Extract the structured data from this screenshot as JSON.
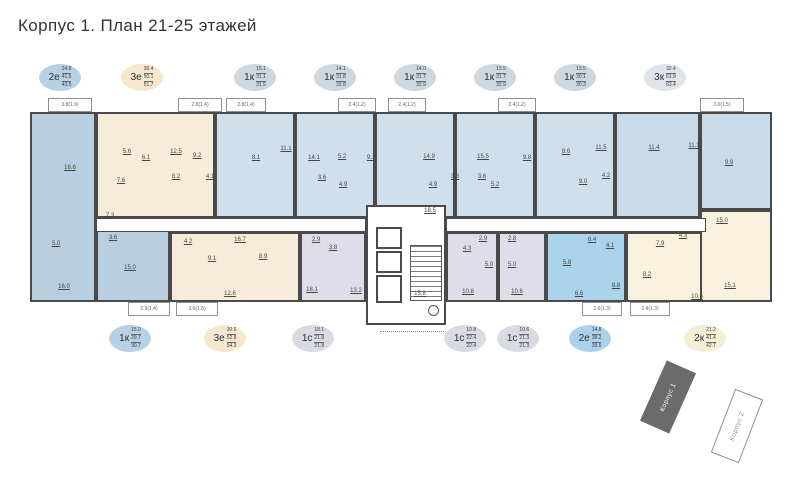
{
  "title": "Корпус 1. План 21-25 этажей",
  "colors": {
    "wall": "#4a4a4a",
    "background": "#ffffff",
    "blue": "#b9cfe0",
    "light_blue": "#cfdfeb",
    "pale_blue": "#c9dbe9",
    "bright_blue": "#abd3ec",
    "beige": "#f6ecd9",
    "cream": "#f7f1dd",
    "lavender": "#dedde8"
  },
  "badges_top": [
    {
      "type": "2е",
      "values": [
        "24.8",
        "41.6",
        "43.5"
      ],
      "fill": "#b8d0e4",
      "x": 60
    },
    {
      "type": "3е",
      "values": [
        "30.4",
        "50.1",
        "51.7"
      ],
      "fill": "#f5e8cf",
      "x": 142
    },
    {
      "type": "1к",
      "values": [
        "15.1",
        "31.1",
        "31.5"
      ],
      "fill": "#ccd8e2",
      "x": 255
    },
    {
      "type": "1к",
      "values": [
        "14.1",
        "31.8",
        "32.8"
      ],
      "fill": "#ccd8e2",
      "x": 335
    },
    {
      "type": "1к",
      "values": [
        "14.0",
        "31.7",
        "32.9"
      ],
      "fill": "#ccd8e2",
      "x": 415
    },
    {
      "type": "1к",
      "values": [
        "13.9",
        "31.7",
        "32.9"
      ],
      "fill": "#ccd8e2",
      "x": 495
    },
    {
      "type": "1к",
      "values": [
        "13.5",
        "30.1",
        "30.3"
      ],
      "fill": "#ccd8e2",
      "x": 575
    },
    {
      "type": "3к",
      "values": [
        "32.4",
        "61.9",
        "63.4"
      ],
      "fill": "#dfe4ea",
      "x": 665
    }
  ],
  "badges_bottom": [
    {
      "type": "1к",
      "values": [
        "15.0",
        "29.7",
        "30.7"
      ],
      "fill": "#b8d0e4",
      "x": 130
    },
    {
      "type": "3е",
      "values": [
        "30.6",
        "52.8",
        "54.3"
      ],
      "fill": "#f5e8cf",
      "x": 225
    },
    {
      "type": "1с",
      "values": [
        "18.1",
        "21.8",
        "21.8"
      ],
      "fill": "#d8dae4",
      "x": 313
    },
    {
      "type": "1с",
      "values": [
        "10.8",
        "22.4",
        "22.4"
      ],
      "fill": "#d8dae4",
      "x": 465
    },
    {
      "type": "1с",
      "values": [
        "10.6",
        "21.3",
        "21.3"
      ],
      "fill": "#d8dae4",
      "x": 518
    },
    {
      "type": "2е",
      "values": [
        "14.8",
        "38.2",
        "39.6"
      ],
      "fill": "#aad2ec",
      "x": 590
    },
    {
      "type": "2к",
      "values": [
        "21.2",
        "41.4",
        "42.7"
      ],
      "fill": "#f5eed6",
      "x": 705
    }
  ],
  "plan": {
    "apartments": [
      {
        "id": "2e-left",
        "fill": "#b9cfe0",
        "x": 30,
        "y": 112,
        "w": 66,
        "h": 190
      },
      {
        "id": "3e-top",
        "fill": "#f6ecd9",
        "x": 96,
        "y": 112,
        "w": 119,
        "h": 106
      },
      {
        "id": "1k-top-1",
        "fill": "#cfdfeb",
        "x": 215,
        "y": 112,
        "w": 80,
        "h": 106
      },
      {
        "id": "1k-top-2",
        "fill": "#cfdfeb",
        "x": 295,
        "y": 112,
        "w": 80,
        "h": 106
      },
      {
        "id": "1k-top-3",
        "fill": "#cfdfeb",
        "x": 375,
        "y": 112,
        "w": 80,
        "h": 106
      },
      {
        "id": "1k-top-4",
        "fill": "#cfdfeb",
        "x": 455,
        "y": 112,
        "w": 80,
        "h": 106
      },
      {
        "id": "1k-top-5",
        "fill": "#cfdfeb",
        "x": 535,
        "y": 112,
        "w": 80,
        "h": 106
      },
      {
        "id": "3k",
        "fill": "#c9dbe9",
        "x": 615,
        "y": 112,
        "w": 85,
        "h": 106
      },
      {
        "id": "3k-wing",
        "fill": "#c9dbe9",
        "x": 700,
        "y": 112,
        "w": 72,
        "h": 98
      },
      {
        "id": "1k-bottom",
        "fill": "#b9cfe0",
        "x": 96,
        "y": 230,
        "w": 74,
        "h": 72
      },
      {
        "id": "3e-bottom",
        "fill": "#f6ecd9",
        "x": 170,
        "y": 232,
        "w": 130,
        "h": 70
      },
      {
        "id": "1c-1",
        "fill": "#dedde8",
        "x": 300,
        "y": 232,
        "w": 66,
        "h": 70
      },
      {
        "id": "1c-2",
        "fill": "#dedde8",
        "x": 446,
        "y": 232,
        "w": 52,
        "h": 70
      },
      {
        "id": "1c-3",
        "fill": "#dedde8",
        "x": 498,
        "y": 232,
        "w": 48,
        "h": 70
      },
      {
        "id": "2e-bottom",
        "fill": "#abd3ec",
        "x": 546,
        "y": 232,
        "w": 80,
        "h": 70
      },
      {
        "id": "2k",
        "fill": "#f7f1dd",
        "x": 626,
        "y": 232,
        "w": 146,
        "h": 70
      },
      {
        "id": "2k-wing",
        "fill": "#f7f1dd",
        "x": 700,
        "y": 210,
        "w": 72,
        "h": 92
      }
    ],
    "corridors": [
      {
        "x": 96,
        "y": 218,
        "w": 270,
        "h": 14
      },
      {
        "x": 446,
        "y": 218,
        "w": 260,
        "h": 14
      }
    ],
    "rooms": [
      {
        "t": "16.6",
        "x": 70,
        "y": 168
      },
      {
        "t": "5.0",
        "x": 56,
        "y": 244
      },
      {
        "t": "16.0",
        "x": 64,
        "y": 287
      },
      {
        "t": "7.3",
        "x": 110,
        "y": 216
      },
      {
        "t": "5.6",
        "x": 127,
        "y": 152
      },
      {
        "t": "6.1",
        "x": 146,
        "y": 158
      },
      {
        "t": "12.5",
        "x": 176,
        "y": 152
      },
      {
        "t": "9.2",
        "x": 197,
        "y": 156
      },
      {
        "t": "7.6",
        "x": 121,
        "y": 181
      },
      {
        "t": "8.2",
        "x": 176,
        "y": 177
      },
      {
        "t": "4.1",
        "x": 210,
        "y": 177
      },
      {
        "t": "8.1",
        "x": 256,
        "y": 158
      },
      {
        "t": "11.1",
        "x": 286,
        "y": 149
      },
      {
        "t": "14.1",
        "x": 314,
        "y": 158
      },
      {
        "t": "5.2",
        "x": 342,
        "y": 157
      },
      {
        "t": "9.2",
        "x": 371,
        "y": 158
      },
      {
        "t": "3.6",
        "x": 322,
        "y": 178
      },
      {
        "t": "4.9",
        "x": 343,
        "y": 185
      },
      {
        "t": "14.9",
        "x": 429,
        "y": 157
      },
      {
        "t": "4.9",
        "x": 433,
        "y": 185
      },
      {
        "t": "3.6",
        "x": 455,
        "y": 177
      },
      {
        "t": "15.5",
        "x": 483,
        "y": 157
      },
      {
        "t": "9.8",
        "x": 527,
        "y": 158
      },
      {
        "t": "3.6",
        "x": 482,
        "y": 177
      },
      {
        "t": "5.2",
        "x": 495,
        "y": 185
      },
      {
        "t": "8.6",
        "x": 566,
        "y": 152
      },
      {
        "t": "11.5",
        "x": 601,
        "y": 148
      },
      {
        "t": "9.0",
        "x": 583,
        "y": 182
      },
      {
        "t": "4.2",
        "x": 606,
        "y": 176
      },
      {
        "t": "11.4",
        "x": 654,
        "y": 148
      },
      {
        "t": "11.1",
        "x": 694,
        "y": 146
      },
      {
        "t": "9.9",
        "x": 729,
        "y": 163
      },
      {
        "t": "15.0",
        "x": 722,
        "y": 221
      },
      {
        "t": "3.6",
        "x": 113,
        "y": 238
      },
      {
        "t": "15.0",
        "x": 130,
        "y": 268
      },
      {
        "t": "4.2",
        "x": 188,
        "y": 242
      },
      {
        "t": "16.7",
        "x": 240,
        "y": 240
      },
      {
        "t": "9.1",
        "x": 212,
        "y": 259
      },
      {
        "t": "8.9",
        "x": 263,
        "y": 257
      },
      {
        "t": "12.6",
        "x": 230,
        "y": 294
      },
      {
        "t": "2.9",
        "x": 316,
        "y": 240
      },
      {
        "t": "3.8",
        "x": 333,
        "y": 248
      },
      {
        "t": "18.1",
        "x": 312,
        "y": 290
      },
      {
        "t": "13.2",
        "x": 356,
        "y": 291
      },
      {
        "t": "4.3",
        "x": 467,
        "y": 249
      },
      {
        "t": "2.9",
        "x": 483,
        "y": 239
      },
      {
        "t": "5.0",
        "x": 489,
        "y": 265
      },
      {
        "t": "10.8",
        "x": 468,
        "y": 292
      },
      {
        "t": "2.8",
        "x": 512,
        "y": 239
      },
      {
        "t": "5.0",
        "x": 512,
        "y": 265
      },
      {
        "t": "10.6",
        "x": 517,
        "y": 292
      },
      {
        "t": "6.4",
        "x": 592,
        "y": 240
      },
      {
        "t": "4.1",
        "x": 610,
        "y": 246
      },
      {
        "t": "5.8",
        "x": 567,
        "y": 263
      },
      {
        "t": "6.6",
        "x": 579,
        "y": 294
      },
      {
        "t": "8.8",
        "x": 616,
        "y": 286
      },
      {
        "t": "7.9",
        "x": 660,
        "y": 244
      },
      {
        "t": "4.3",
        "x": 683,
        "y": 236
      },
      {
        "t": "8.2",
        "x": 647,
        "y": 275
      },
      {
        "t": "10.5",
        "x": 697,
        "y": 297
      },
      {
        "t": "15.1",
        "x": 730,
        "y": 286
      },
      {
        "t": "18.5",
        "x": 430,
        "y": 211
      },
      {
        "t": "15.8",
        "x": 420,
        "y": 294
      }
    ],
    "balconies_top": [
      {
        "t": "3.8(1.9)",
        "x": 48,
        "w": 44
      },
      {
        "t": "2.8(1.4)",
        "x": 178,
        "w": 44
      },
      {
        "t": "2.8(1.4)",
        "x": 226,
        "w": 40
      },
      {
        "t": "2.4(1.2)",
        "x": 338,
        "w": 38
      },
      {
        "t": "2.4(1.2)",
        "x": 388,
        "w": 38
      },
      {
        "t": "2.4(1.2)",
        "x": 498,
        "w": 38
      },
      {
        "t": "3.0(1.5)",
        "x": 700,
        "w": 44
      }
    ],
    "balconies_bottom": [
      {
        "t": "2.9(1.4)",
        "x": 128,
        "w": 42
      },
      {
        "t": "3.0(1.5)",
        "x": 176,
        "w": 42
      },
      {
        "t": "2.6(1.3)",
        "x": 582,
        "w": 40
      },
      {
        "t": "2.4(1.3)",
        "x": 630,
        "w": 40
      }
    ]
  },
  "keyplan": {
    "building1": "Корпус 1",
    "building2": "Корпус 2"
  }
}
